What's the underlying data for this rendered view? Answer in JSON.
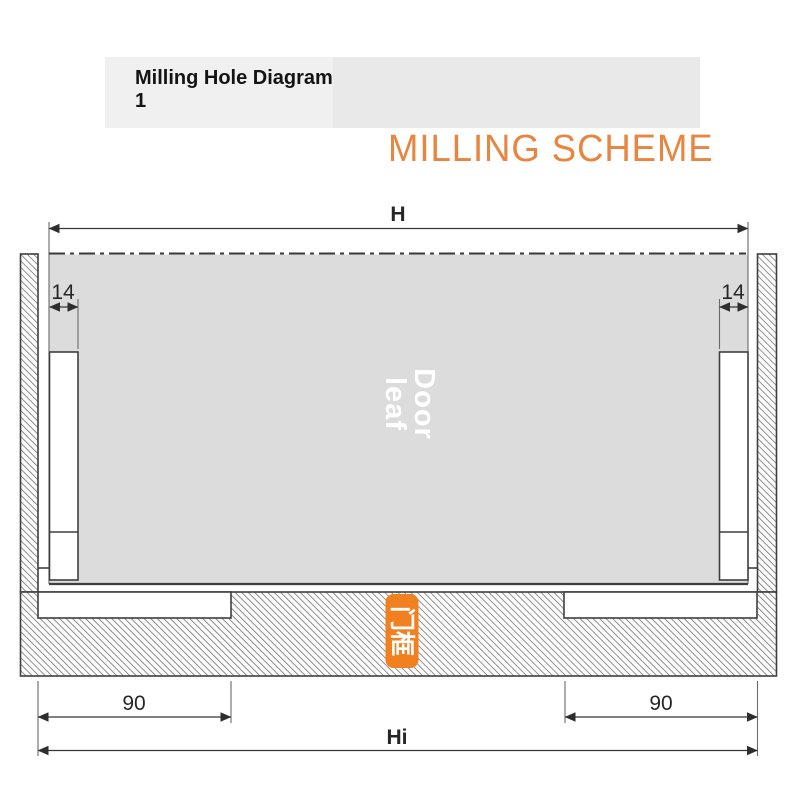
{
  "header": {
    "title_line1": "Milling Hole Diagram",
    "title_line2": "1",
    "scheme_label": "MILLING SCHEME"
  },
  "diagram": {
    "door_leaf_label": {
      "line1": "Door",
      "line2": "leaf"
    },
    "door_frame_label": "门框",
    "dimensions": {
      "top_width": "H",
      "bottom_width": "Hi",
      "left_edge_offset": "14",
      "right_edge_offset": "14",
      "left_slot_width": "90",
      "right_slot_width": "90"
    }
  },
  "colors": {
    "accent_orange": "#E8853E",
    "badge_orange": "#F08020",
    "door_leaf_gray": "#DCDCDC",
    "header_bar_gray": "#E9E9E9",
    "line_dark": "#3F3F3F"
  }
}
